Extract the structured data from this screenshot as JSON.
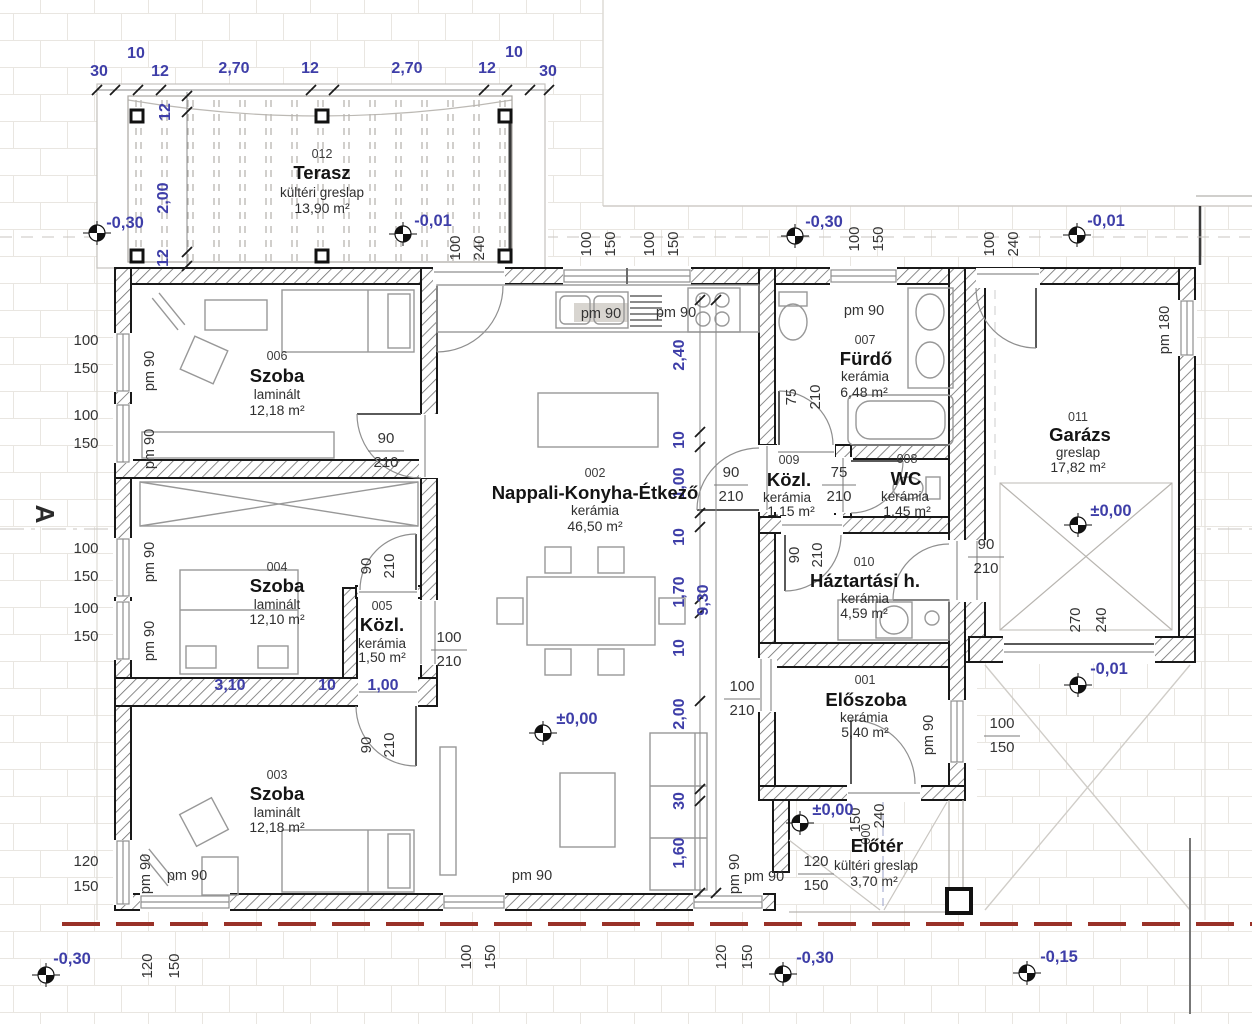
{
  "colors": {
    "dim_blue": "#3e3ea8",
    "wall": "#191919",
    "property_line": "#993128",
    "paving_grid": "#e9e6e1"
  },
  "rooms": {
    "terasz": {
      "num": "012",
      "name": "Terasz",
      "mat": "kültéri greslap",
      "area": "13,90 m²"
    },
    "szoba006": {
      "num": "006",
      "name": "Szoba",
      "mat": "laminált",
      "area": "12,18 m²"
    },
    "szoba004": {
      "num": "004",
      "name": "Szoba",
      "mat": "laminált",
      "area": "12,10 m²"
    },
    "kozl005": {
      "num": "005",
      "name": "Közl.",
      "mat": "kerámia",
      "area": "1,50 m²"
    },
    "szoba003": {
      "num": "003",
      "name": "Szoba",
      "mat": "laminált",
      "area": "12,18 m²"
    },
    "nappali": {
      "num": "002",
      "name": "Nappali-Konyha-Étkező",
      "mat": "kerámia",
      "area": "46,50 m²"
    },
    "furdo": {
      "num": "007",
      "name": "Fürdő",
      "mat": "kerámia",
      "area": "6,48 m²"
    },
    "kozl009": {
      "num": "009",
      "name": "Közl.",
      "mat": "kerámia",
      "area": "1,15 m²"
    },
    "wc": {
      "num": "008",
      "name": "WC",
      "mat": "kerámia",
      "area": "1,45 m²"
    },
    "haztartasi": {
      "num": "010",
      "name": "Háztartási h.",
      "mat": "kerámia",
      "area": "4,59 m²"
    },
    "eloszoba": {
      "num": "001",
      "name": "Előszoba",
      "mat": "kerámia",
      "area": "5,40 m²"
    },
    "eloter": {
      "num": "000",
      "name": "Előtér",
      "mat": "kültéri greslap",
      "area": "3,70 m²"
    },
    "garazs": {
      "num": "011",
      "name": "Garázs",
      "mat": "greslap",
      "area": "17,82 m²"
    }
  },
  "levels": {
    "minus030": "-0,30",
    "minus001": "-0,01",
    "zero": "±0,00",
    "minus015": "-0,15"
  },
  "chains": {
    "top": [
      "30",
      "10",
      "12",
      "2,70",
      "12",
      "2,70",
      "12",
      "10",
      "30"
    ],
    "terasz_left": [
      "12",
      "2,00",
      "12"
    ],
    "nappali_right": [
      "2,40",
      "10",
      "1,00",
      "10",
      "1,70",
      "10",
      "2,00",
      "30",
      "1,60"
    ],
    "nappali_total": "9,30",
    "szoba004_bottom": [
      "3,10",
      "10",
      "1,00"
    ]
  },
  "pairs": {
    "p90_210": [
      "90",
      "210"
    ],
    "p75_210": [
      "75",
      "210"
    ],
    "p100_210": [
      "100",
      "210"
    ],
    "p100_240": [
      "100",
      "240"
    ],
    "p100_150": [
      "100",
      "150"
    ],
    "p120_150": [
      "120",
      "150"
    ],
    "p270_240": [
      "270",
      "240"
    ],
    "p150_240": [
      "150",
      "240"
    ]
  },
  "pm": {
    "pm90": "pm 90",
    "pm180": "pm 180"
  },
  "section_mark": "A"
}
